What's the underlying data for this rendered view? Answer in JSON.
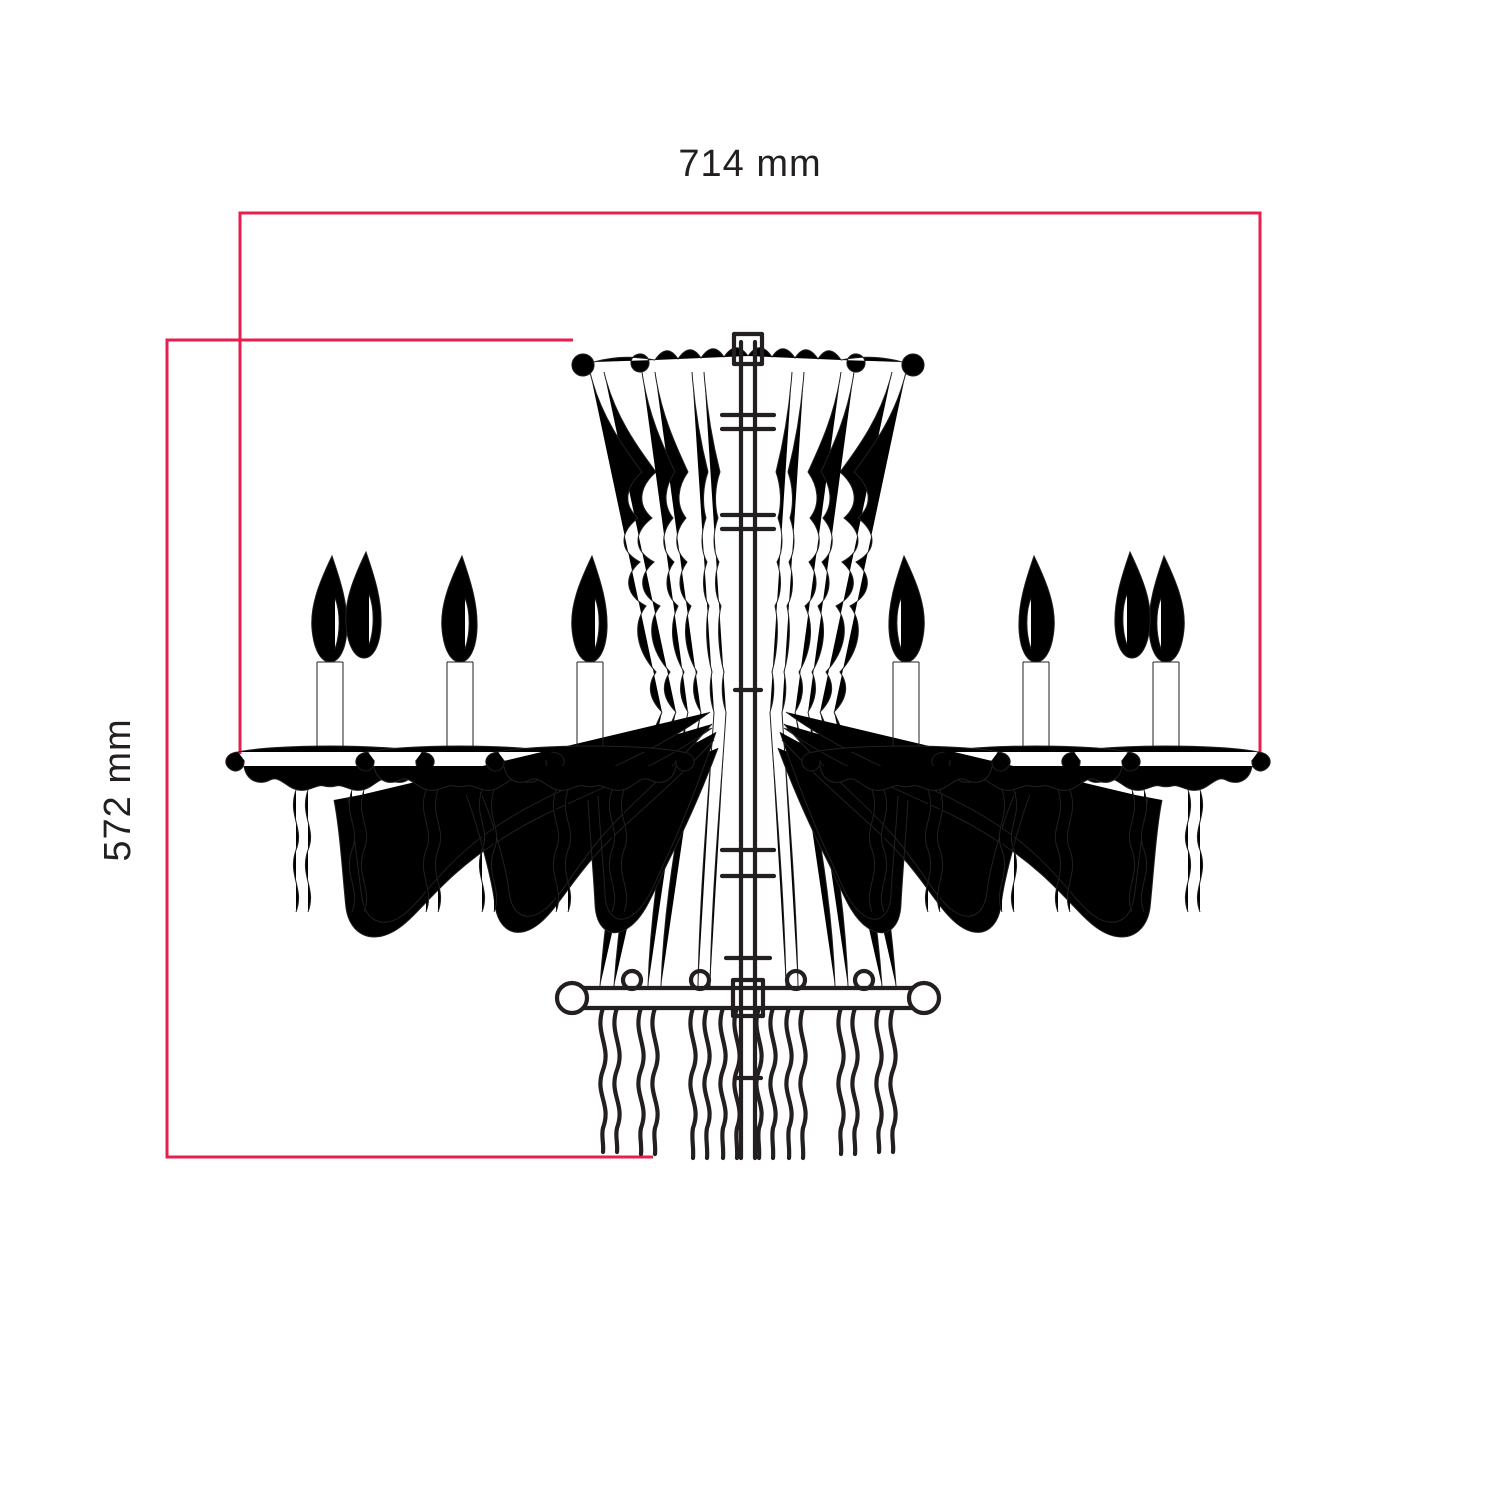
{
  "figure": {
    "subject": "chandelier",
    "view": "dimension line drawing"
  },
  "colors": {
    "background": "#ffffff",
    "ink": "#231f20",
    "dimension": "#e71e4f",
    "label_text": "#231f20"
  },
  "dimension_labels": {
    "width": "714 mm",
    "height": "572 mm"
  },
  "dimension_values_mm": {
    "width": 714,
    "height": 572
  }
}
